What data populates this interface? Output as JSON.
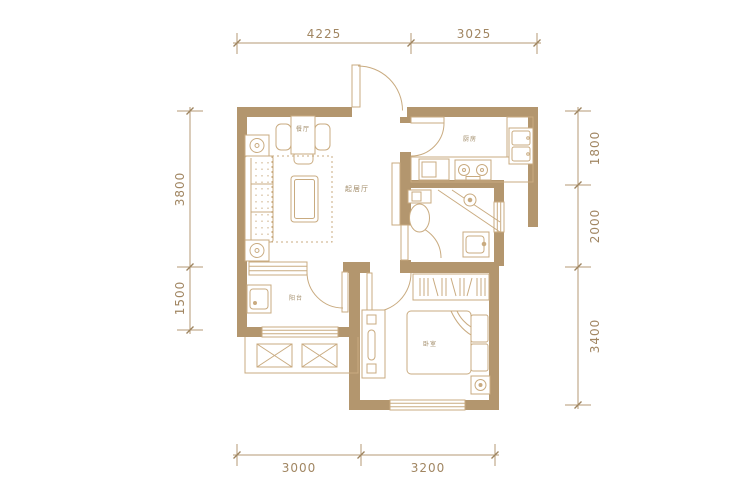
{
  "plan": {
    "type": "apartment-floor-plan",
    "rooms": {
      "dining": {
        "label": "餐厅"
      },
      "living": {
        "label": "起居厅"
      },
      "kitchen": {
        "label": "厨房"
      },
      "balcony": {
        "label": "阳台"
      },
      "bedroom": {
        "label": "卧室"
      }
    },
    "dimensions": {
      "top": {
        "d1": "4225",
        "d2": "3025"
      },
      "left": {
        "d1": "3800",
        "d2": "1500"
      },
      "right": {
        "d1": "1800",
        "d2": "2000",
        "d3": "3400"
      },
      "bottom": {
        "d1": "3000",
        "d2": "3200"
      }
    },
    "colors": {
      "wall": "#b3966e",
      "furniture_line": "#c9ab80",
      "dimension_line": "#b69a74",
      "dimension_text": "#a18662",
      "background": "#ffffff"
    }
  }
}
